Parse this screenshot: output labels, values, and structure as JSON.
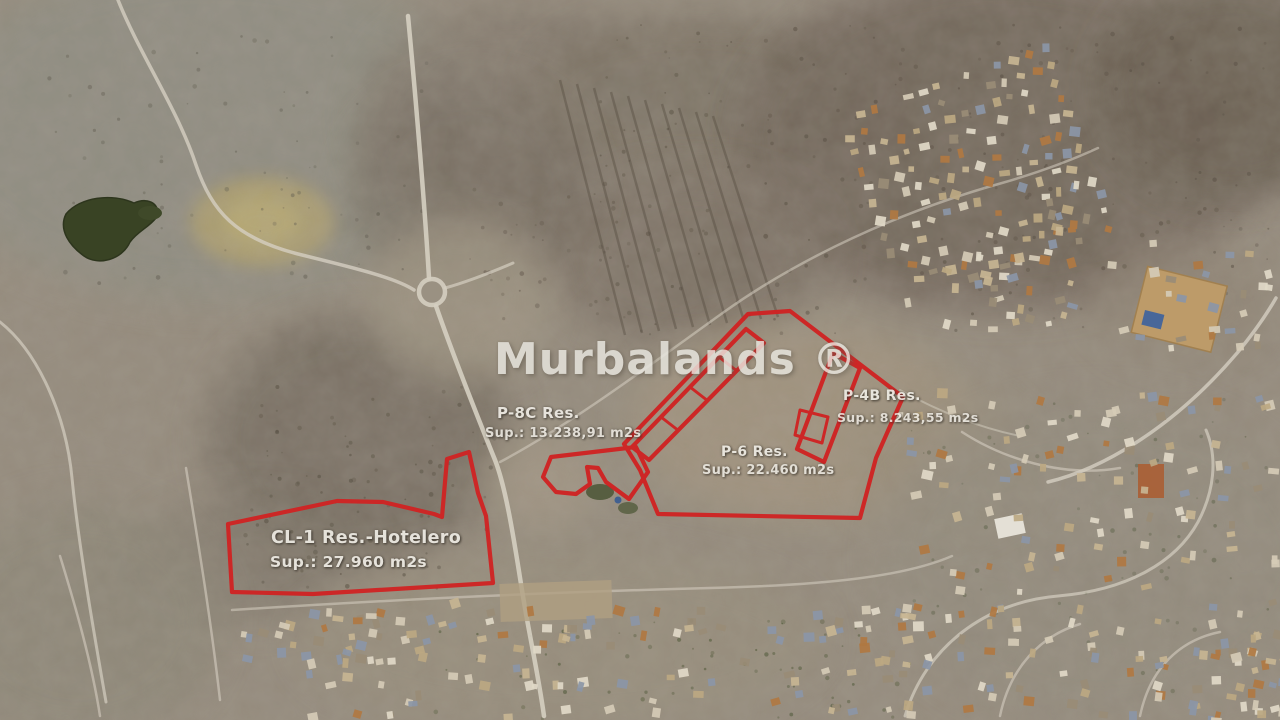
{
  "watermark": {
    "text": "Murbalands ®"
  },
  "map": {
    "type": "aerial-satellite-photo",
    "parcel_outline_color": "#de1d1d",
    "label_color": "#eeebe4"
  },
  "parcels": {
    "cl1": {
      "name": "CL-1 Res.-Hotelero",
      "area": "Sup.: 27.960 m2s"
    },
    "p8c": {
      "name": "P-8C Res.",
      "area": "Sup.: 13.238,91 m2s"
    },
    "p6": {
      "name": "P-6 Res.",
      "area": "Sup.: 22.460 m2s"
    },
    "p4b": {
      "name": "P-4B Res.",
      "area": "Sup.: 8.243,55 m2s"
    }
  }
}
